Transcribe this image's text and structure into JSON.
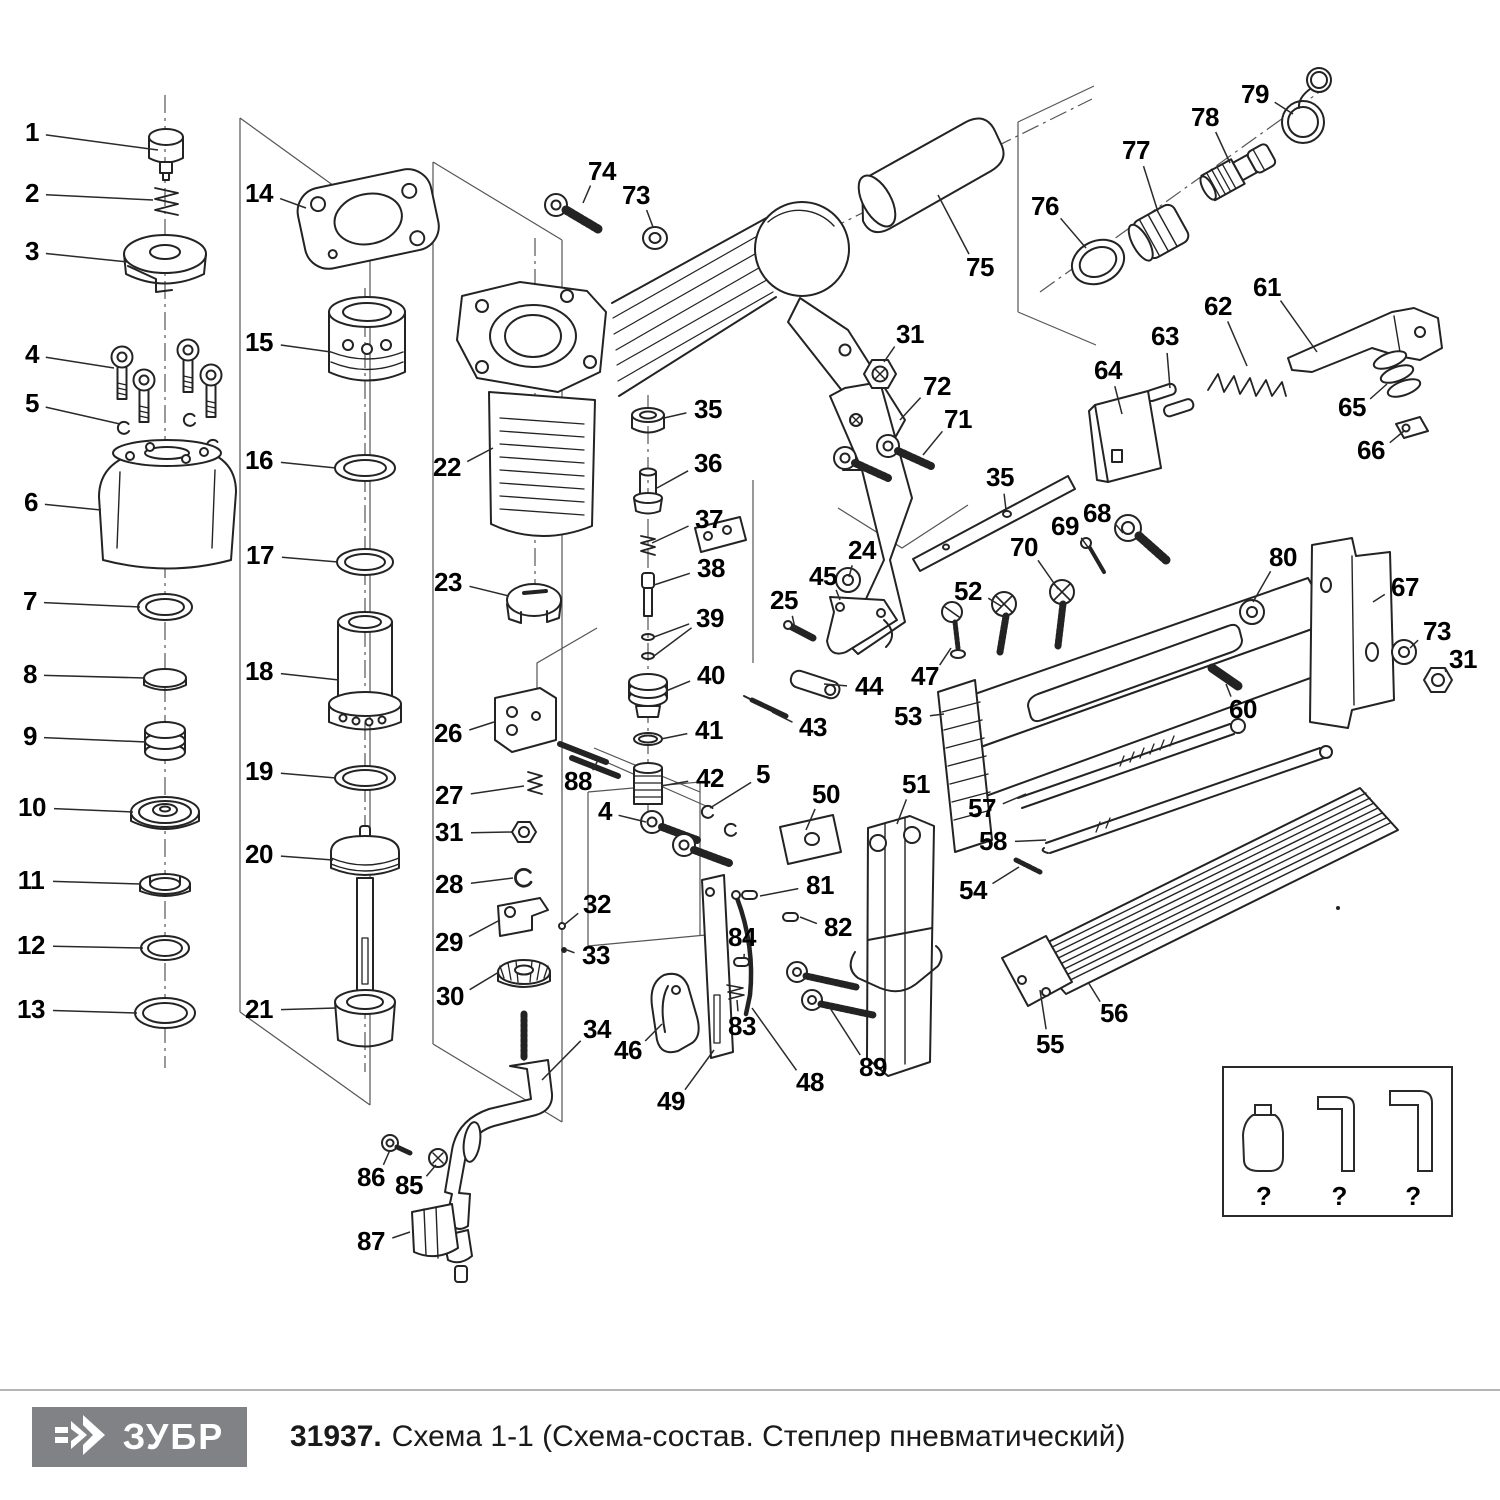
{
  "footer": {
    "logo_text": "ЗУБР",
    "doc_number": "31937.",
    "title_rest": "Схема 1-1 (Схема-состав. Степлер пневматический)"
  },
  "unknown_parts_box": {
    "items": [
      {
        "icon": "oil-bottle-icon",
        "label": "?"
      },
      {
        "icon": "hex-key-small-icon",
        "label": "?"
      },
      {
        "icon": "hex-key-large-icon",
        "label": "?"
      }
    ]
  },
  "colors": {
    "line": "#232323",
    "construction": "#555555",
    "label": "#000000",
    "logo_bg": "#808285",
    "logo_fg": "#ffffff",
    "rule": "#b5b5b5"
  },
  "callouts": [
    {
      "n": "1",
      "x": 32,
      "y": 133,
      "tx": 158,
      "ty": 150
    },
    {
      "n": "2",
      "x": 32,
      "y": 194,
      "tx": 153,
      "ty": 200
    },
    {
      "n": "3",
      "x": 32,
      "y": 252,
      "tx": 128,
      "ty": 262
    },
    {
      "n": "4",
      "x": 32,
      "y": 355,
      "tx": 114,
      "ty": 368
    },
    {
      "n": "5",
      "x": 32,
      "y": 404,
      "tx": 120,
      "ty": 424
    },
    {
      "n": "6",
      "x": 31,
      "y": 503,
      "tx": 101,
      "ty": 510
    },
    {
      "n": "7",
      "x": 30,
      "y": 602,
      "tx": 140,
      "ty": 607
    },
    {
      "n": "8",
      "x": 30,
      "y": 675,
      "tx": 145,
      "ty": 678
    },
    {
      "n": "9",
      "x": 30,
      "y": 737,
      "tx": 146,
      "ty": 742
    },
    {
      "n": "10",
      "x": 32,
      "y": 808,
      "tx": 133,
      "ty": 812
    },
    {
      "n": "11",
      "x": 31,
      "y": 881,
      "tx": 141,
      "ty": 884
    },
    {
      "n": "12",
      "x": 31,
      "y": 946,
      "tx": 143,
      "ty": 948
    },
    {
      "n": "13",
      "x": 31,
      "y": 1010,
      "tx": 137,
      "ty": 1013
    },
    {
      "n": "14",
      "x": 259,
      "y": 194,
      "tx": 306,
      "ty": 208
    },
    {
      "n": "15",
      "x": 259,
      "y": 343,
      "tx": 331,
      "ty": 352
    },
    {
      "n": "16",
      "x": 259,
      "y": 461,
      "tx": 336,
      "ty": 468
    },
    {
      "n": "17",
      "x": 260,
      "y": 556,
      "tx": 338,
      "ty": 562
    },
    {
      "n": "18",
      "x": 259,
      "y": 672,
      "tx": 339,
      "ty": 680
    },
    {
      "n": "19",
      "x": 259,
      "y": 772,
      "tx": 336,
      "ty": 778
    },
    {
      "n": "20",
      "x": 259,
      "y": 855,
      "tx": 333,
      "ty": 860
    },
    {
      "n": "21",
      "x": 259,
      "y": 1010,
      "tx": 336,
      "ty": 1008
    },
    {
      "n": "22",
      "x": 447,
      "y": 468,
      "tx": 493,
      "ty": 448
    },
    {
      "n": "23",
      "x": 448,
      "y": 583,
      "tx": 509,
      "ty": 596
    },
    {
      "n": "24",
      "x": 862,
      "y": 551,
      "tx": 849,
      "ty": 577
    },
    {
      "n": "25",
      "x": 784,
      "y": 601,
      "tx": 795,
      "ty": 628
    },
    {
      "n": "26",
      "x": 448,
      "y": 734,
      "tx": 494,
      "ty": 722
    },
    {
      "n": "27",
      "x": 449,
      "y": 796,
      "tx": 524,
      "ty": 786
    },
    {
      "n": "31",
      "x": 449,
      "y": 833,
      "tx": 512,
      "ty": 832
    },
    {
      "n": "28",
      "x": 449,
      "y": 885,
      "tx": 513,
      "ty": 878
    },
    {
      "n": "29",
      "x": 449,
      "y": 943,
      "tx": 500,
      "ty": 920
    },
    {
      "n": "30",
      "x": 450,
      "y": 997,
      "tx": 499,
      "ty": 972
    },
    {
      "n": "32",
      "x": 597,
      "y": 905,
      "tx": 564,
      "ty": 925
    },
    {
      "n": "33",
      "x": 596,
      "y": 956,
      "tx": 567,
      "ty": 950
    },
    {
      "n": "34",
      "x": 597,
      "y": 1030,
      "tx": 542,
      "ty": 1080
    },
    {
      "n": "35",
      "x": 708,
      "y": 410,
      "tx": 664,
      "ty": 418
    },
    {
      "n": "36",
      "x": 708,
      "y": 464,
      "tx": 657,
      "ty": 488
    },
    {
      "n": "37",
      "x": 709,
      "y": 520,
      "tx": 652,
      "ty": 543
    },
    {
      "n": "38",
      "x": 711,
      "y": 569,
      "tx": 654,
      "ty": 585
    },
    {
      "n": "39",
      "x": 710,
      "y": 619,
      "tx": 654,
      "ty": 637,
      "tx2": 654,
      "ty2": 656
    },
    {
      "n": "40",
      "x": 711,
      "y": 676,
      "tx": 666,
      "ty": 691
    },
    {
      "n": "41",
      "x": 709,
      "y": 731,
      "tx": 661,
      "ty": 739
    },
    {
      "n": "42",
      "x": 710,
      "y": 779,
      "tx": 661,
      "ty": 786
    },
    {
      "n": "43",
      "x": 813,
      "y": 728,
      "tx": 772,
      "ty": 712
    },
    {
      "n": "44",
      "x": 869,
      "y": 687,
      "tx": 824,
      "ty": 684
    },
    {
      "n": "45",
      "x": 823,
      "y": 577,
      "tx": 840,
      "ty": 600
    },
    {
      "n": "46",
      "x": 628,
      "y": 1051,
      "tx": 662,
      "ty": 1024
    },
    {
      "n": "47",
      "x": 925,
      "y": 677,
      "tx": 951,
      "ty": 648
    },
    {
      "n": "48",
      "x": 810,
      "y": 1083,
      "tx": 752,
      "ty": 1008
    },
    {
      "n": "49",
      "x": 671,
      "y": 1102,
      "tx": 714,
      "ty": 1050
    },
    {
      "n": "50",
      "x": 826,
      "y": 795,
      "tx": 806,
      "ty": 830
    },
    {
      "n": "51",
      "x": 916,
      "y": 785,
      "tx": 897,
      "ty": 824
    },
    {
      "n": "52",
      "x": 968,
      "y": 592,
      "tx": 1001,
      "ty": 606
    },
    {
      "n": "53",
      "x": 908,
      "y": 717,
      "tx": 944,
      "ty": 714
    },
    {
      "n": "54",
      "x": 973,
      "y": 891,
      "tx": 1019,
      "ty": 867
    },
    {
      "n": "55",
      "x": 1050,
      "y": 1045,
      "tx": 1040,
      "ty": 990
    },
    {
      "n": "56",
      "x": 1114,
      "y": 1014,
      "tx": 1088,
      "ty": 982
    },
    {
      "n": "57",
      "x": 982,
      "y": 809,
      "tx": 1026,
      "ty": 794
    },
    {
      "n": "58",
      "x": 993,
      "y": 842,
      "tx": 1046,
      "ty": 840
    },
    {
      "n": "60",
      "x": 1243,
      "y": 710,
      "tx": 1226,
      "ty": 684
    },
    {
      "n": "61",
      "x": 1267,
      "y": 288,
      "tx": 1317,
      "ty": 352
    },
    {
      "n": "62",
      "x": 1218,
      "y": 307,
      "tx": 1247,
      "ty": 366
    },
    {
      "n": "63",
      "x": 1165,
      "y": 337,
      "tx": 1170,
      "ty": 388
    },
    {
      "n": "64",
      "x": 1108,
      "y": 371,
      "tx": 1122,
      "ty": 414
    },
    {
      "n": "65",
      "x": 1352,
      "y": 408,
      "tx": 1387,
      "ty": 384
    },
    {
      "n": "66",
      "x": 1371,
      "y": 451,
      "tx": 1404,
      "ty": 431
    },
    {
      "n": "67",
      "x": 1405,
      "y": 588,
      "tx": 1373,
      "ty": 602
    },
    {
      "n": "68",
      "x": 1097,
      "y": 514,
      "tx": 1123,
      "ty": 533
    },
    {
      "n": "69",
      "x": 1065,
      "y": 527,
      "tx": 1090,
      "ty": 550
    },
    {
      "n": "70",
      "x": 1024,
      "y": 548,
      "tx": 1058,
      "ty": 589
    },
    {
      "n": "71",
      "x": 958,
      "y": 420,
      "tx": 923,
      "ty": 455
    },
    {
      "n": "72",
      "x": 937,
      "y": 387,
      "tx": 900,
      "ty": 420
    },
    {
      "n": "73",
      "x": 636,
      "y": 196,
      "tx": 653,
      "ty": 227
    },
    {
      "n": "74",
      "x": 602,
      "y": 172,
      "tx": 583,
      "ty": 203
    },
    {
      "n": "75",
      "x": 980,
      "y": 268,
      "tx": 938,
      "ty": 195
    },
    {
      "n": "76",
      "x": 1045,
      "y": 207,
      "tx": 1086,
      "ty": 248
    },
    {
      "n": "77",
      "x": 1136,
      "y": 151,
      "tx": 1158,
      "ty": 212
    },
    {
      "n": "78",
      "x": 1205,
      "y": 118,
      "tx": 1230,
      "ty": 163
    },
    {
      "n": "79",
      "x": 1255,
      "y": 95,
      "tx": 1293,
      "ty": 114
    },
    {
      "n": "80",
      "x": 1283,
      "y": 558,
      "tx": 1253,
      "ty": 602
    },
    {
      "n": "81",
      "x": 820,
      "y": 886,
      "tx": 760,
      "ty": 896
    },
    {
      "n": "82",
      "x": 838,
      "y": 928,
      "tx": 800,
      "ty": 917
    },
    {
      "n": "83",
      "x": 742,
      "y": 1027,
      "tx": 737,
      "ty": 1000
    },
    {
      "n": "84",
      "x": 742,
      "y": 938,
      "tx": 744,
      "ty": 958
    },
    {
      "n": "85",
      "x": 409,
      "y": 1186,
      "tx": 436,
      "ty": 1165
    },
    {
      "n": "86",
      "x": 371,
      "y": 1178,
      "tx": 390,
      "ty": 1150
    },
    {
      "n": "87",
      "x": 371,
      "y": 1242,
      "tx": 410,
      "ty": 1232
    },
    {
      "n": "88",
      "x": 578,
      "y": 782,
      "tx": 598,
      "ty": 760
    },
    {
      "n": "89",
      "x": 873,
      "y": 1068,
      "tx": 830,
      "ty": 1008
    },
    {
      "n": "31",
      "x": 910,
      "y": 335,
      "tx": 884,
      "ty": 362
    },
    {
      "n": "31",
      "x": 1463,
      "y": 660,
      "tx": 1446,
      "ty": 672
    },
    {
      "n": "35",
      "x": 1000,
      "y": 478,
      "tx": 1006,
      "ty": 510
    },
    {
      "n": "4",
      "x": 605,
      "y": 812,
      "tx": 646,
      "ty": 822
    },
    {
      "n": "5",
      "x": 763,
      "y": 775,
      "tx": 710,
      "ty": 808
    },
    {
      "n": "73",
      "x": 1437,
      "y": 632,
      "tx": 1410,
      "ty": 648
    }
  ]
}
